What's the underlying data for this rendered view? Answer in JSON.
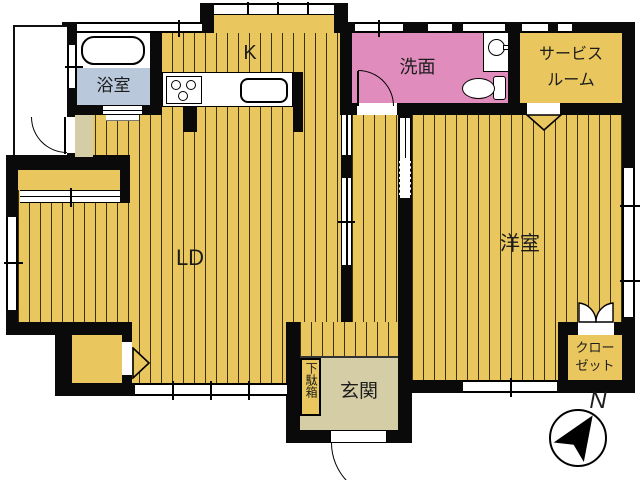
{
  "plan": {
    "title": "floor-plan",
    "rooms": {
      "bathroom": {
        "label": "浴室",
        "floor_color": "#bac8dc"
      },
      "kitchen": {
        "label": "K",
        "floor_color": "#eac75e"
      },
      "washroom": {
        "label": "洗面",
        "floor_color": "#e08cbc"
      },
      "service_room": {
        "label_line1": "サービス",
        "label_line2": "ルーム",
        "floor_color": "#eac75e"
      },
      "living_dining": {
        "label": "LD",
        "floor_color": "#eac75e"
      },
      "western_room": {
        "label": "洋室",
        "floor_color": "#eac75e"
      },
      "closet": {
        "label_line1": "クロー",
        "label_line2": "ゼット",
        "floor_color": "#eac75e"
      },
      "entrance": {
        "label": "玄関",
        "floor_color": "#d5cda6"
      },
      "shoe_cabinet": {
        "label": "下駄箱",
        "floor_color": "#eac75e"
      }
    },
    "compass": {
      "label": "N"
    },
    "fixtures": [
      "bathtub",
      "stove",
      "kitchen-sink",
      "toilet",
      "hand-basin"
    ],
    "colors": {
      "floor_yellow": "#eac75e",
      "stripe_line": "#39320a",
      "washroom_pink": "#e08cbc",
      "bathroom_blue": "#bac8dc",
      "entrance_beige": "#d5cda6",
      "wall_black": "#0a0a0a",
      "background": "#ffffff"
    }
  }
}
